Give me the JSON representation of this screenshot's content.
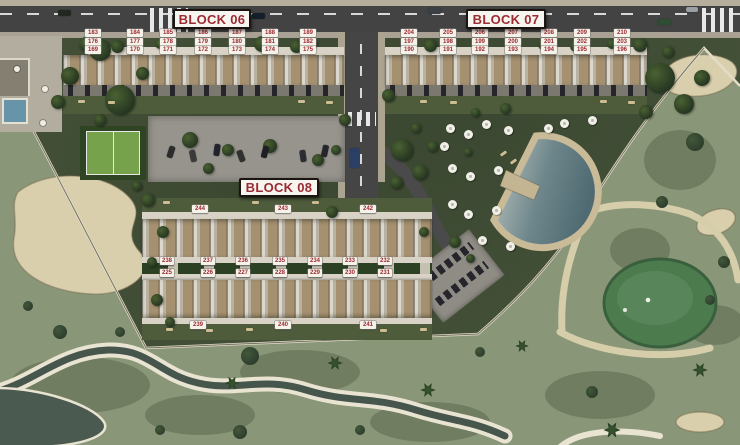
{
  "signs": {
    "block06": "BLOCK 06",
    "block07": "BLOCK 07",
    "block08": "BLOCK 08"
  },
  "block06": {
    "rows": [
      [
        "183",
        "184",
        "185",
        "186",
        "187",
        "188",
        "189"
      ],
      [
        "176",
        "177",
        "178",
        "179",
        "180",
        "181",
        "182"
      ],
      [
        "169",
        "170",
        "171",
        "172",
        "173",
        "174",
        "175"
      ]
    ]
  },
  "block07": {
    "rows": [
      [
        "204",
        "205",
        "206",
        "207",
        "208",
        "209",
        "210"
      ],
      [
        "197",
        "198",
        "199",
        "200",
        "201",
        "202",
        "203"
      ],
      [
        "190",
        "191",
        "192",
        "193",
        "194",
        "195",
        "196"
      ]
    ]
  },
  "block08": {
    "top": [
      "244",
      "243",
      "242"
    ],
    "upper_pairs": [
      [
        "224",
        "238"
      ],
      [
        "223",
        "237"
      ],
      [
        "222",
        "236"
      ],
      [
        "221",
        "235"
      ],
      [
        "220",
        "234"
      ],
      [
        "219",
        "233"
      ],
      [
        "218",
        "232"
      ]
    ],
    "lower_pairs": [
      [
        "211",
        "225"
      ],
      [
        "212",
        "226"
      ],
      [
        "213",
        "227"
      ],
      [
        "214",
        "228"
      ],
      [
        "215",
        "229"
      ],
      [
        "216",
        "230"
      ],
      [
        "217",
        "231"
      ]
    ],
    "bottom": [
      "239",
      "240",
      "241"
    ]
  },
  "colors": {
    "label_text": "#9c2a31",
    "label_bg": "#f5f2ea",
    "sign_border": "#1a1510",
    "asphalt": "#434343",
    "grounds_green": "#47543b",
    "golf_green": "#8a9678",
    "putting_green": "#4c7c4e",
    "sand": "#d9cfad",
    "water": "#46564c",
    "pool_deck": "#cabb98"
  }
}
